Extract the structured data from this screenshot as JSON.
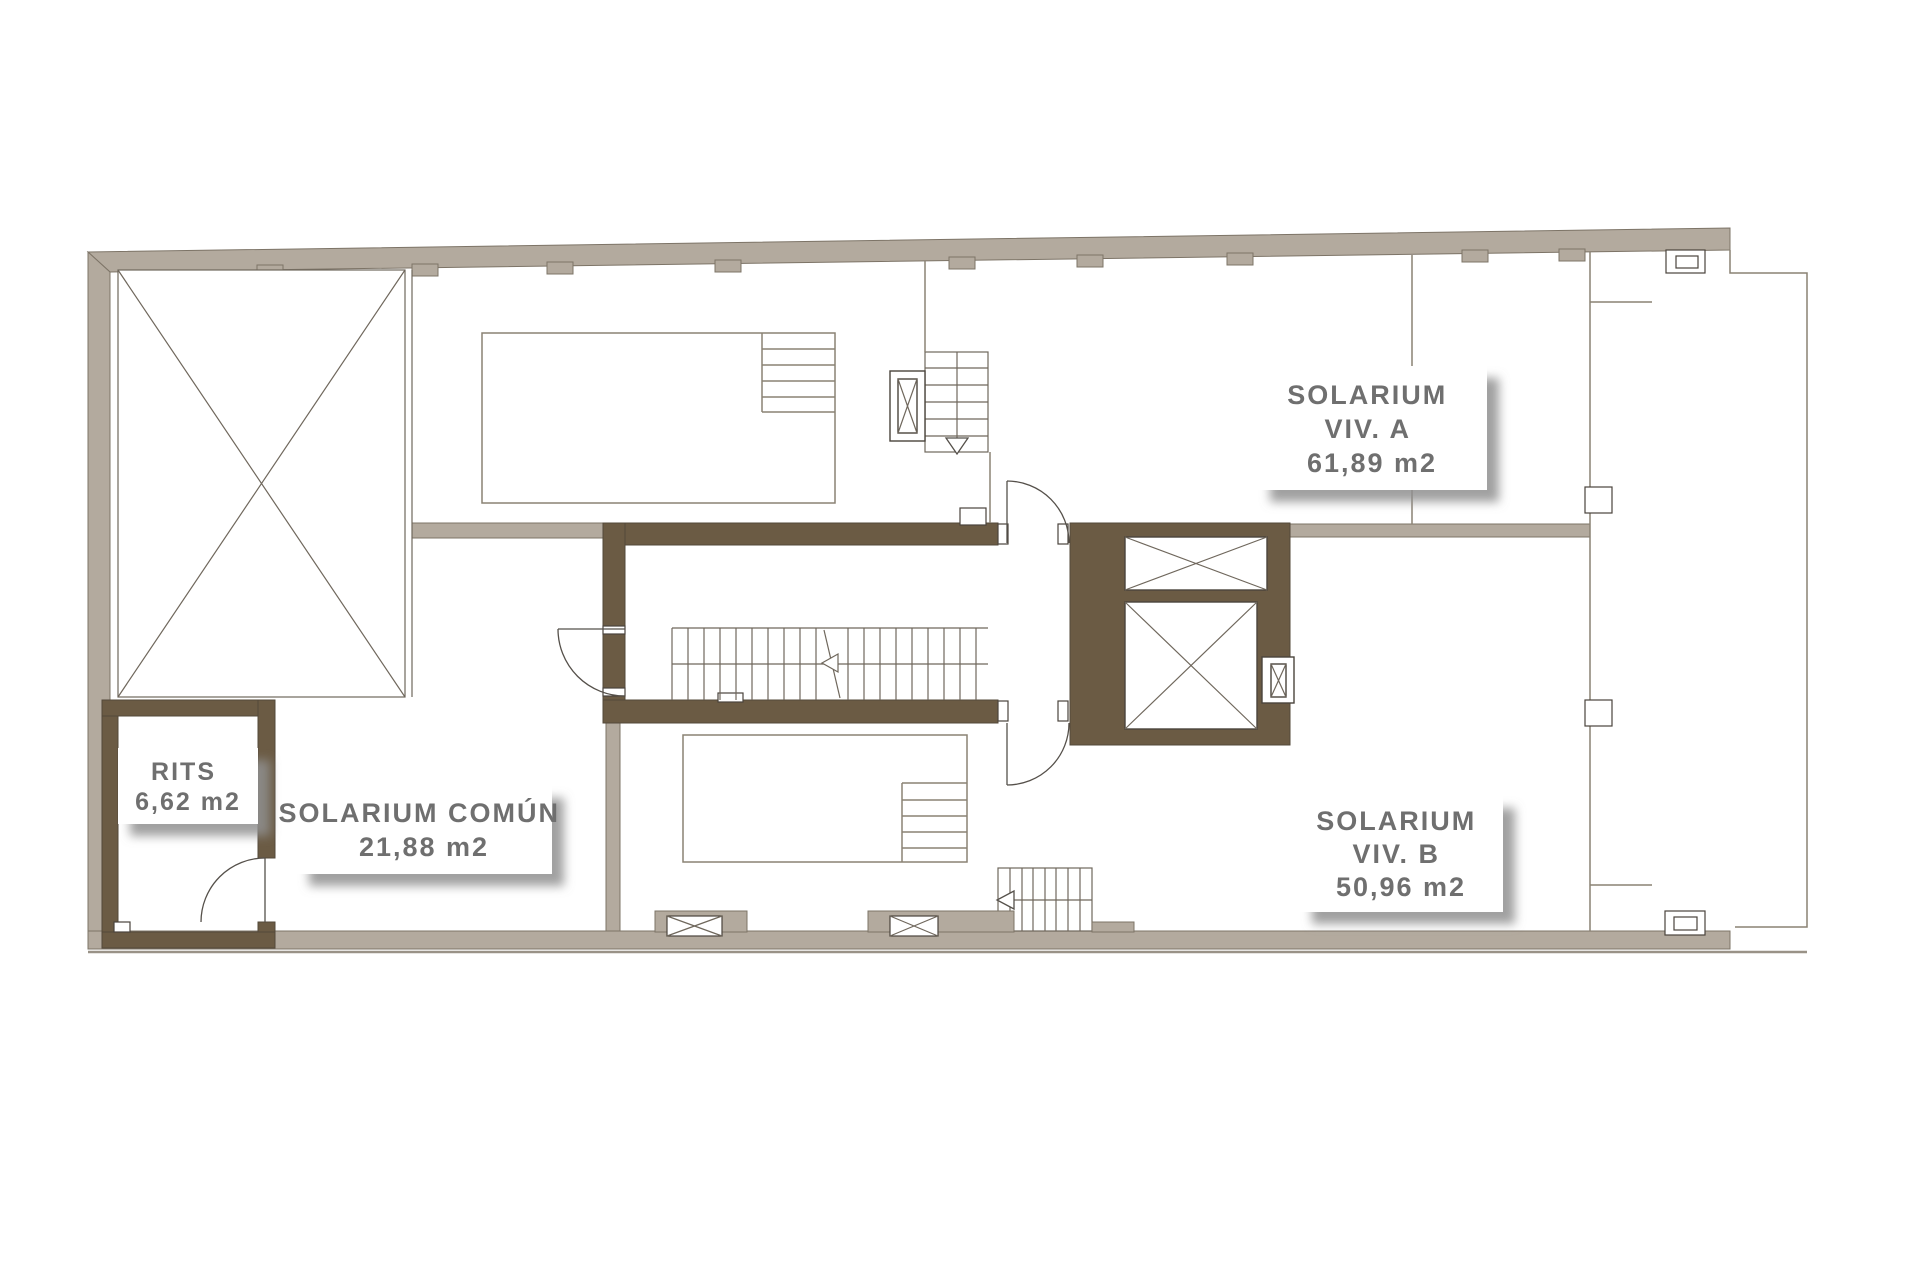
{
  "plan": {
    "type": "architectural-floor-plan",
    "level": "solarium-roof-level",
    "labels": {
      "viv_a": {
        "line1": "SOLARIUM",
        "line2": "VIV. A",
        "line3": "61,89 m2"
      },
      "viv_b": {
        "line1": "SOLARIUM",
        "line2": "VIV. B",
        "line3": "50,96 m2"
      },
      "comun": {
        "line1": "SOLARIUM COMÚN",
        "line2": "21,88 m2"
      },
      "rits": {
        "line1": "RITS",
        "line2": "6,62 m2"
      }
    },
    "colors": {
      "outer_wall": "#b3aa9e",
      "core_wall": "#6b5b44",
      "thin_line": "#8a8274",
      "label_text": "#6f6f6f",
      "shadow": "#8f8f8f",
      "background": "#ffffff"
    }
  }
}
